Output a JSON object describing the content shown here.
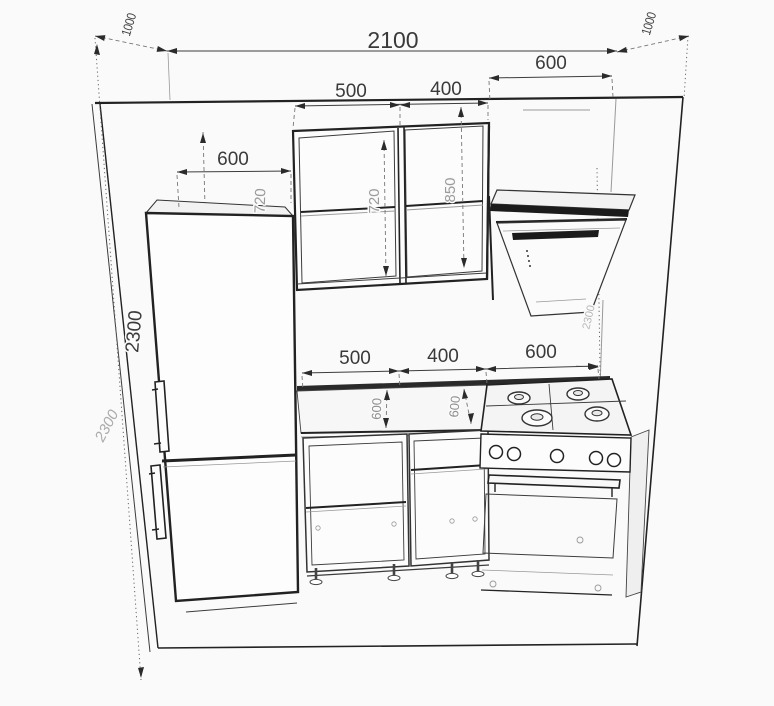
{
  "drawing": {
    "type": "kitchen-elevation-perspective-drawing",
    "background_color": "#fafafa",
    "line_color": "#222222",
    "dim_text_color": "#3a3a3a",
    "faint_dim_text_color": "#9a9a9a",
    "objects": [
      "room-walls",
      "refrigerator",
      "wall-cabinet-500",
      "wall-cabinet-400",
      "range-hood",
      "countertop",
      "base-cabinet-500",
      "base-cabinet-400",
      "gas-stove-with-oven"
    ],
    "dims": {
      "total_width": "2100",
      "side_wall_depth_left": "1000",
      "side_wall_depth_right": "1000",
      "fridge_width": "600",
      "upper_cabinet_1_width": "500",
      "upper_cabinet_2_width": "400",
      "hood_width": "600",
      "base_cabinet_1_width": "500",
      "base_cabinet_2_width": "400",
      "stove_width": "600",
      "wall_height": "2300",
      "wall_height_sketch": "2300",
      "wall_height_right": "2300",
      "upper_cabinet_height_edge": "720",
      "upper_cabinet_height_1": "720",
      "upper_cabinet_height_2": "850",
      "counter_depth_1": "600",
      "counter_depth_2": "600"
    }
  }
}
